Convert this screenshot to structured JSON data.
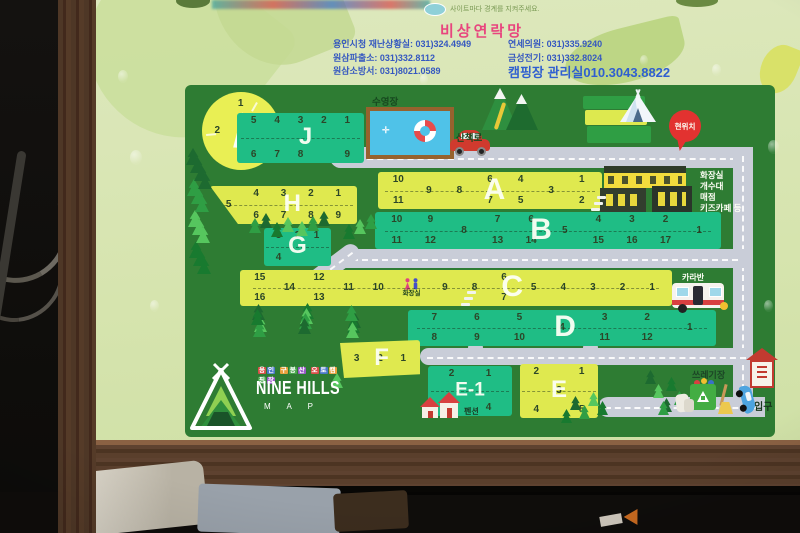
{
  "sign": {
    "top_note": "사이트마다 경계를 지켜주세요.",
    "emergency": {
      "title": "비상연락망",
      "contacts_left": [
        {
          "label": "용인시청 재난상황실",
          "phone": "031)324.4949"
        },
        {
          "label": "원삼파출소",
          "phone": "031)332.8112"
        },
        {
          "label": "원삼소방서",
          "phone": "031)8021.0589"
        }
      ],
      "contacts_right": [
        {
          "label": "연세의원",
          "phone": "031)335.9240"
        },
        {
          "label": "금성전기",
          "phone": "031)332.8024"
        }
      ],
      "manager_label": "캠핑장 관리실",
      "manager_phone": "010.3043.8822"
    },
    "logo": {
      "subtitle": "용인 구봉산 오토캠핑장",
      "title": "NINE HILLS",
      "caption": "M A P"
    }
  },
  "map": {
    "labels": {
      "pool": "수영장",
      "trail": "산책로",
      "current_location": "현위치",
      "facilities": [
        "화장실",
        "개수대",
        "매점",
        "키즈카페 등"
      ],
      "caravan": "카라반",
      "restroom": "화장실",
      "pension": "펜션",
      "trash": "쓰레기장",
      "entrance": "입구"
    },
    "sections": [
      {
        "id": "I",
        "sites": [
          "1",
          "2",
          "3"
        ]
      },
      {
        "id": "J",
        "cols": [
          {
            "t": "5",
            "b": "6"
          },
          {
            "t": "4",
            "b": "7"
          },
          {
            "t": "3",
            "b": "8"
          },
          {
            "t": "2"
          },
          {
            "t": "1",
            "b": "9"
          }
        ]
      },
      {
        "id": "H",
        "cols": [
          {
            "c": "5"
          },
          {
            "t": "4",
            "b": "6"
          },
          {
            "t": "3",
            "b": "7"
          },
          {
            "t": "2",
            "b": "8"
          },
          {
            "t": "1",
            "b": "9"
          }
        ]
      },
      {
        "id": "G",
        "cols": [
          {
            "t": "3",
            "b": "4"
          },
          {
            "t": "2"
          },
          {
            "t": "1"
          }
        ]
      },
      {
        "id": "A",
        "cols": [
          {
            "t": "10",
            "b": "11"
          },
          {
            "c": "9"
          },
          {
            "c": "8"
          },
          {
            "t": "6",
            "b": "7"
          },
          {
            "t": "4",
            "b": "5"
          },
          {
            "c": "3"
          },
          {
            "t": "1",
            "b": "2"
          }
        ]
      },
      {
        "id": "B",
        "cols": [
          {
            "t": "10",
            "b": "11"
          },
          {
            "t": "9",
            "b": "12"
          },
          {
            "c": "8"
          },
          {
            "t": "7",
            "b": "13"
          },
          {
            "t": "6",
            "b": "14"
          },
          {
            "c": "5"
          },
          {
            "t": "4",
            "b": "15"
          },
          {
            "t": "3",
            "b": "16"
          },
          {
            "t": "2",
            "b": "17"
          },
          {
            "c": "1"
          }
        ]
      },
      {
        "id": "C",
        "cols": [
          {
            "t": "15",
            "b": "16"
          },
          {
            "c": "14"
          },
          {
            "t": "12",
            "b": "13"
          },
          {
            "c": "11"
          },
          {
            "c": "10"
          },
          {
            "icon": "restroom"
          },
          {
            "c": "9"
          },
          {
            "c": "8"
          },
          {
            "t": "6",
            "b": "7"
          },
          {
            "c": "5"
          },
          {
            "c": "4"
          },
          {
            "c": "3"
          },
          {
            "c": "2"
          },
          {
            "c": "1"
          }
        ]
      },
      {
        "id": "D",
        "cols": [
          {
            "t": "7",
            "b": "8"
          },
          {
            "t": "6",
            "b": "9"
          },
          {
            "t": "5",
            "b": "10"
          },
          {
            "c": "4"
          },
          {
            "t": "3",
            "b": "11"
          },
          {
            "t": "2",
            "b": "12"
          },
          {
            "c": "1"
          }
        ]
      },
      {
        "id": "F",
        "cols": [
          {
            "c": "3"
          },
          {
            "c": "2"
          },
          {
            "c": "1"
          }
        ]
      },
      {
        "id": "E-1",
        "cols": [
          {
            "t": "2",
            "b": "3"
          },
          {
            "t": "1",
            "b": "4"
          }
        ]
      },
      {
        "id": "E",
        "cols": [
          {
            "t": "2",
            "b": "4"
          },
          {
            "c": "3"
          },
          {
            "t": "1",
            "b": "5"
          }
        ]
      }
    ]
  }
}
